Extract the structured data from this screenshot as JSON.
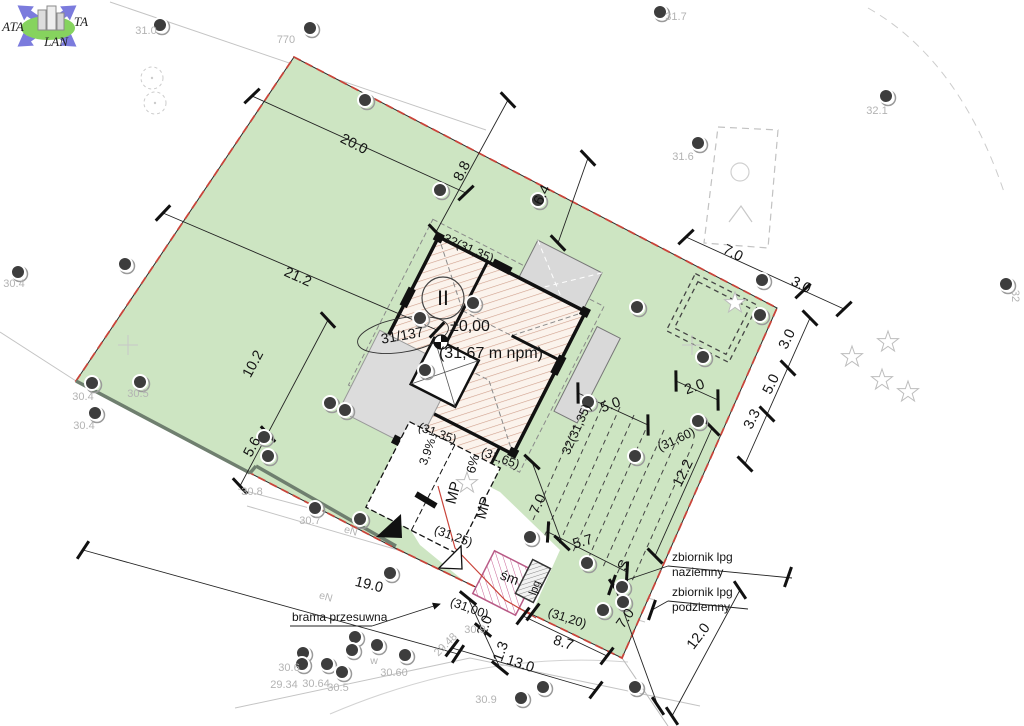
{
  "logo": {
    "ata": "ATA",
    "ta": "TA",
    "lan": "LAN"
  },
  "building": {
    "storeys": "II",
    "level_zero": "±0,00",
    "level_above_sea": "(31,67 m npm)",
    "plot_number": "31/137"
  },
  "colors": {
    "plot_green": "#cde5c2",
    "boundary_red": "#c9443a",
    "hatch_line": "#cf9f8c",
    "roof_gray": "#d9d9d9",
    "spot_gray": "#b3b3b3",
    "trash_pink": "#c75f93",
    "logo_blue": "#7b7bdd",
    "logo_green": "#86d35e"
  },
  "annotations": {
    "dimensions": [
      {
        "t": "20.0",
        "x": 352,
        "y": 148,
        "r": 27
      },
      {
        "t": "21.2",
        "x": 296,
        "y": 281,
        "r": 24
      },
      {
        "t": "10.2",
        "x": 257,
        "y": 366,
        "r": -62
      },
      {
        "t": "5.6",
        "x": 256,
        "y": 449,
        "r": -62
      },
      {
        "t": "8.8",
        "x": 466,
        "y": 173,
        "r": -63
      },
      {
        "t": "6.4",
        "x": 546,
        "y": 197,
        "r": -63
      },
      {
        "t": "7.0",
        "x": 731,
        "y": 257,
        "r": 27
      },
      {
        "t": "3.0",
        "x": 799,
        "y": 289,
        "r": 27
      },
      {
        "t": "3.0",
        "x": 791,
        "y": 341,
        "r": -64
      },
      {
        "t": "5.0",
        "x": 775,
        "y": 386,
        "r": -64
      },
      {
        "t": "3.3",
        "x": 756,
        "y": 421,
        "r": -64
      },
      {
        "t": "2.0",
        "x": 696,
        "y": 391,
        "r": -20
      },
      {
        "t": "12.2",
        "x": 687,
        "y": 475,
        "r": -64
      },
      {
        "t": "5.0",
        "x": 612,
        "y": 409,
        "r": -20
      },
      {
        "t": "5.7",
        "x": 584,
        "y": 546,
        "r": -16
      },
      {
        "t": "7.0",
        "x": 542,
        "y": 506,
        "r": -66
      },
      {
        "t": "7.0",
        "x": 629,
        "y": 621,
        "r": -55
      },
      {
        "t": "12.0",
        "x": 702,
        "y": 639,
        "r": -53
      },
      {
        "t": "8.7",
        "x": 562,
        "y": 647,
        "r": 18
      },
      {
        "t": "13.0",
        "x": 519,
        "y": 668,
        "r": 18
      },
      {
        "t": "1.3",
        "x": 505,
        "y": 653,
        "r": -70
      },
      {
        "t": "2.0",
        "x": 489,
        "y": 627,
        "r": -70
      },
      {
        "t": "19.0",
        "x": 368,
        "y": 589,
        "r": 14
      }
    ],
    "corner_levels": [
      {
        "t": "32(31,35)",
        "x": 467,
        "y": 252,
        "r": 24
      },
      {
        "t": "32(31,35)",
        "x": 580,
        "y": 431,
        "r": -66
      },
      {
        "t": "(31,35)",
        "x": 436,
        "y": 437,
        "r": 20
      },
      {
        "t": "(31,65)",
        "x": 499,
        "y": 462,
        "r": 20
      },
      {
        "t": "(31,25)",
        "x": 452,
        "y": 540,
        "r": 20
      },
      {
        "t": "(31,00)",
        "x": 468,
        "y": 612,
        "r": 20
      },
      {
        "t": "(31,20)",
        "x": 566,
        "y": 622,
        "r": 18
      },
      {
        "t": "(31,60)",
        "x": 678,
        "y": 443,
        "r": -25
      }
    ],
    "building_labels": [
      {
        "n": "building-level-zero",
        "t": "±0,00",
        "x": 470,
        "y": 331,
        "s": 16
      },
      {
        "n": "building-level-asl",
        "t": "(31,67 m npm)",
        "x": 491,
        "y": 358,
        "s": 16
      },
      {
        "n": "storey-count",
        "t": "II",
        "x": 443,
        "y": 305,
        "s": 21
      },
      {
        "n": "plot-number",
        "t": "31/137",
        "x": 403,
        "y": 340,
        "r": -10,
        "s": 14
      }
    ],
    "area_labels": [
      {
        "n": "parking-label",
        "t": "MP",
        "x": 458,
        "y": 494,
        "r": -75,
        "s": 15
      },
      {
        "n": "parking-label",
        "t": "MP",
        "x": 488,
        "y": 509,
        "r": -75,
        "s": 15
      },
      {
        "n": "slope-label",
        "t": "6%",
        "x": 477,
        "y": 465,
        "r": -75,
        "s": 13
      },
      {
        "n": "slope-label",
        "t": "3,9%",
        "x": 431,
        "y": 453,
        "r": -70,
        "s": 12
      },
      {
        "n": "trash-label",
        "t": "śm",
        "x": 508,
        "y": 582,
        "r": 20,
        "s": 14
      },
      {
        "n": "lpg-label",
        "t": "lpg",
        "x": 538,
        "y": 589,
        "r": -70,
        "s": 11
      },
      {
        "n": "gas-connection-label",
        "t": "S",
        "x": 628,
        "y": 567,
        "r": -66,
        "s": 15
      }
    ],
    "text_labels": [
      {
        "n": "tank-above-line1",
        "t": "zbiornik lpg",
        "x": 672,
        "y": 561
      },
      {
        "n": "tank-above-line2",
        "t": "naziemny",
        "x": 672,
        "y": 576
      },
      {
        "n": "tank-below-line1",
        "t": "zbiornik lpg",
        "x": 672,
        "y": 596
      },
      {
        "n": "tank-below-line2",
        "t": "podziemny",
        "x": 672,
        "y": 611
      },
      {
        "n": "sliding-gate-label",
        "t": "brama przesuwna",
        "x": 292,
        "y": 621
      }
    ],
    "spot_elevations": [
      {
        "t": "31.0",
        "x": 146,
        "y": 34
      },
      {
        "t": "770",
        "x": 286,
        "y": 43
      },
      {
        "t": "31.7",
        "x": 676,
        "y": 20
      },
      {
        "t": "32.1",
        "x": 877,
        "y": 114
      },
      {
        "t": "31.6",
        "x": 683,
        "y": 160
      },
      {
        "t": "30.4",
        "x": 14,
        "y": 287
      },
      {
        "t": "30.4",
        "x": 83,
        "y": 400
      },
      {
        "t": "30.4",
        "x": 84,
        "y": 429
      },
      {
        "t": "30.5",
        "x": 138,
        "y": 397
      },
      {
        "t": "30.8",
        "x": 252,
        "y": 495
      },
      {
        "t": "30.7",
        "x": 310,
        "y": 524
      },
      {
        "t": "30.9",
        "x": 475,
        "y": 633
      },
      {
        "t": "30.9",
        "x": 486,
        "y": 703
      },
      {
        "t": "30.6",
        "x": 289,
        "y": 671
      },
      {
        "t": "29.34",
        "x": 284,
        "y": 688
      },
      {
        "t": "30.64",
        "x": 316,
        "y": 687
      },
      {
        "t": "30.5",
        "x": 338,
        "y": 691
      },
      {
        "t": "30.60",
        "x": 394,
        "y": 676
      },
      {
        "t": "29.48",
        "x": 448,
        "y": 647,
        "r": -45
      },
      {
        "t": "32",
        "x": 1012,
        "y": 296,
        "r": 90
      }
    ],
    "utility_labels": [
      {
        "t": "eN",
        "x": 350,
        "y": 534,
        "r": 16
      },
      {
        "t": "eN",
        "x": 325,
        "y": 600,
        "r": 16
      },
      {
        "t": "w",
        "x": 374,
        "y": 664
      }
    ]
  },
  "symbols": {
    "trees": [
      [
        160,
        25
      ],
      [
        310,
        28
      ],
      [
        660,
        12
      ],
      [
        365,
        100
      ],
      [
        440,
        190
      ],
      [
        538,
        200
      ],
      [
        18,
        272
      ],
      [
        125,
        264
      ],
      [
        886,
        96
      ],
      [
        698,
        143
      ],
      [
        1006,
        284
      ],
      [
        92,
        383
      ],
      [
        140,
        382
      ],
      [
        95,
        413
      ],
      [
        330,
        403
      ],
      [
        345,
        410
      ],
      [
        264,
        437
      ],
      [
        268,
        456
      ],
      [
        588,
        402
      ],
      [
        698,
        421
      ],
      [
        635,
        456
      ],
      [
        762,
        280
      ],
      [
        760,
        315
      ],
      [
        703,
        357
      ],
      [
        637,
        307
      ],
      [
        315,
        508
      ],
      [
        360,
        519
      ],
      [
        390,
        573
      ],
      [
        355,
        637
      ],
      [
        303,
        653
      ],
      [
        352,
        650
      ],
      [
        377,
        645
      ],
      [
        327,
        664
      ],
      [
        342,
        672
      ],
      [
        302,
        664
      ],
      [
        405,
        655
      ],
      [
        530,
        537
      ],
      [
        587,
        563
      ],
      [
        622,
        587
      ],
      [
        623,
        602
      ],
      [
        603,
        610
      ],
      [
        635,
        687
      ],
      [
        543,
        687
      ],
      [
        521,
        698
      ],
      [
        420,
        318
      ],
      [
        473,
        303
      ],
      [
        425,
        370
      ]
    ],
    "shrubs": [
      [
        888,
        342
      ],
      [
        882,
        380
      ],
      [
        908,
        392
      ],
      [
        852,
        357
      ],
      [
        735,
        303
      ],
      [
        467,
        483
      ]
    ],
    "tree_rings": [
      [
        152,
        78
      ],
      [
        155,
        103
      ]
    ]
  }
}
